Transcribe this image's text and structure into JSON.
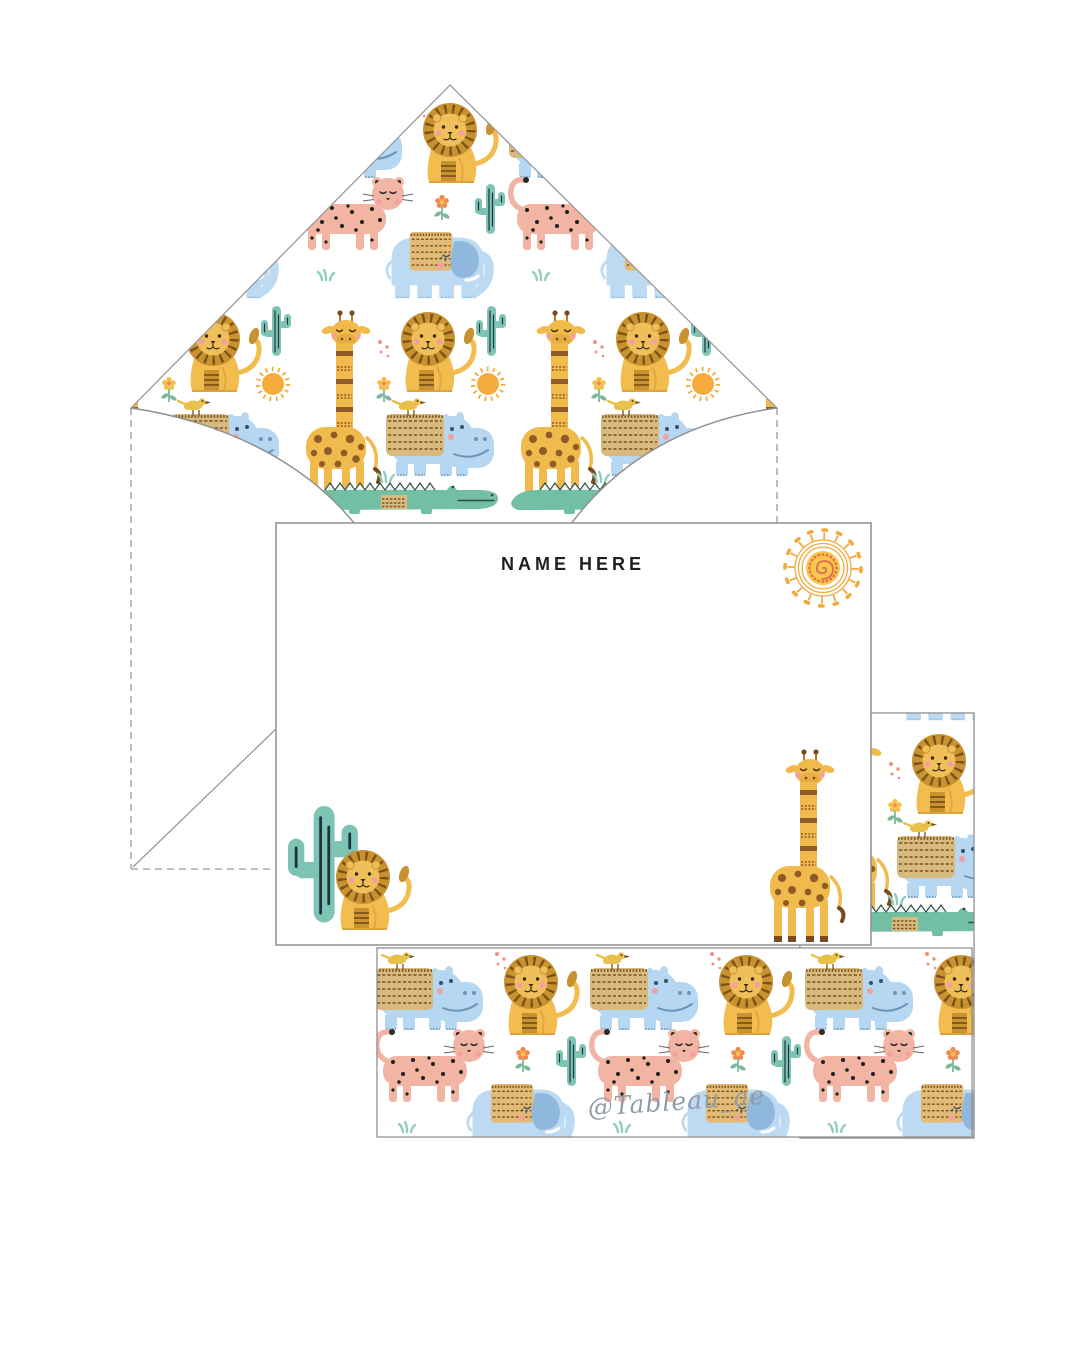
{
  "card_front": {
    "name_placeholder": "NAME HERE"
  },
  "watermark": {
    "handle": "@Tableau_ae"
  },
  "scene": {
    "items": [
      "envelope-with-safari-liner",
      "flat-notecard-front",
      "pattern-card-right",
      "pattern-card-bottom"
    ]
  },
  "pattern_animals": [
    "lion",
    "giraffe",
    "elephant",
    "hippo",
    "leopard",
    "crocodile",
    "cactus",
    "sun",
    "flower",
    "grass",
    "dots"
  ],
  "colors": {
    "lion_mane": "#C99231",
    "lion_mane_line": "#7A5217",
    "lion_body": "#F3BC4F",
    "lion_face": "#EFC05A",
    "giraffe_body": "#F0BA4D",
    "spot_brown": "#8F5B26",
    "band_brown": "#7A5220",
    "elephant_blue": "#BCDAF2",
    "elephant_ear": "#8FB8DC",
    "hippo_blue": "#B5D7F1",
    "hippo_line": "#6C93B8",
    "leopard_pink": "#F2B5A4",
    "leopard_spot": "#1F1F1F",
    "croc_green": "#72BFA3",
    "croc_line": "#2E4D42",
    "cactus_teal": "#7EC4B4",
    "cactus_line": "#1D3340",
    "blanket_gold": "#D9BA7E",
    "bird_yellow": "#E8C04A",
    "sun_ring": "#F2A93B",
    "sun_disc": "#F9C64F",
    "sun_spiral": "#DB6E52",
    "flower_orange": "#F08A4B",
    "flower_yellow": "#F5C04A",
    "stem_green": "#7CB89A",
    "dots_coral": "#F09080",
    "grass_teal": "#8FCDBD",
    "cheek_pink": "#F5A0A0",
    "outline_gray": "#9A9A9A",
    "text_black": "#1F1F1F",
    "watermark_gray": "#929CA8"
  }
}
